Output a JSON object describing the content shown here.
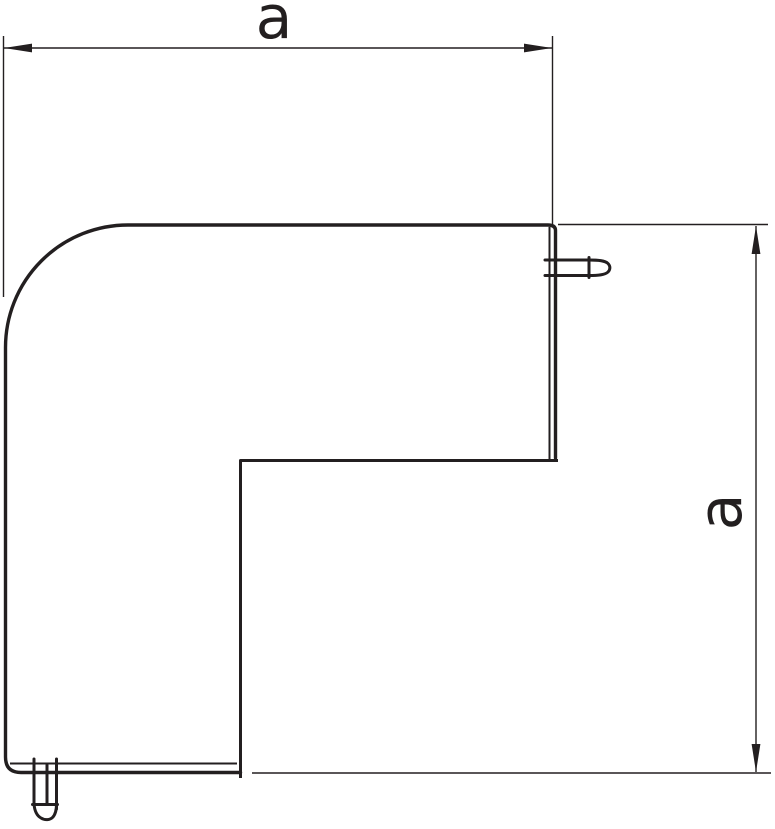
{
  "dimensions": {
    "width": {
      "label": "a"
    },
    "height": {
      "label": "a"
    }
  },
  "colors": {
    "ink": "#231f20",
    "background": "#ffffff"
  }
}
